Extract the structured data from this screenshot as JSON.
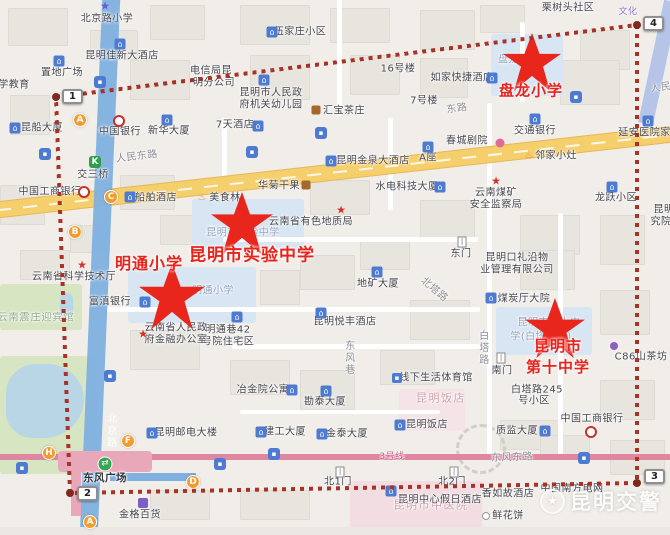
{
  "watermark": {
    "text": "昆明交警"
  },
  "colors": {
    "boundary_dash": "#a93226",
    "school_red": "#e8231c",
    "road_yellow": "#f6cf6d",
    "metro_blue": "#7fb0e0",
    "line3_pink": "#df87a0",
    "station_orange": "#f39c2d"
  },
  "boundary": {
    "corners": [
      [
        56,
        97
      ],
      [
        637,
        25
      ],
      [
        637,
        483
      ],
      [
        70,
        493
      ]
    ],
    "markers": [
      {
        "n": "1",
        "x": 62,
        "y": 89
      },
      {
        "n": "2",
        "x": 77,
        "y": 486
      },
      {
        "n": "3",
        "x": 644,
        "y": 469
      },
      {
        "n": "4",
        "x": 643,
        "y": 16
      }
    ]
  },
  "schools": [
    {
      "name": "盘龙小学",
      "star": {
        "x": 532,
        "y": 62,
        "s": 58
      },
      "label": {
        "lines": [
          "盘龙小学"
        ],
        "x": 531,
        "y": 90,
        "fs": 15
      }
    },
    {
      "name": "明通小学",
      "star": {
        "x": 172,
        "y": 296,
        "s": 66
      },
      "label": {
        "lines": [
          "明通小学"
        ],
        "x": 149,
        "y": 262,
        "fs": 16
      }
    },
    {
      "name": "昆明市实验中学",
      "star": {
        "x": 242,
        "y": 223,
        "s": 62
      },
      "label": {
        "lines": [
          "昆明市实验中学"
        ],
        "x": 252,
        "y": 253,
        "fs": 17
      }
    },
    {
      "name": "昆明市第十中学",
      "star": {
        "x": 555,
        "y": 328,
        "s": 60
      },
      "label": {
        "lines": [
          "昆明市",
          "第十中学"
        ],
        "x": 558,
        "y": 356,
        "fs": 15
      }
    }
  ],
  "stations": [
    {
      "l": "A",
      "x": 80,
      "y": 120
    },
    {
      "l": "C",
      "x": 111,
      "y": 197
    },
    {
      "l": "B",
      "x": 75,
      "y": 232
    },
    {
      "l": "H",
      "x": 49,
      "y": 453
    },
    {
      "l": "F",
      "x": 128,
      "y": 441
    },
    {
      "l": "D",
      "x": 193,
      "y": 482
    },
    {
      "l": "A",
      "x": 90,
      "y": 522
    }
  ],
  "buses": [
    {
      "x": 45,
      "y": 154
    },
    {
      "x": 100,
      "y": 82
    },
    {
      "x": 252,
      "y": 152
    },
    {
      "x": 321,
      "y": 133
    },
    {
      "x": 576,
      "y": 97
    },
    {
      "x": 584,
      "y": 458
    },
    {
      "x": 22,
      "y": 468
    },
    {
      "x": 220,
      "y": 464
    },
    {
      "x": 274,
      "y": 454
    },
    {
      "x": 110,
      "y": 376
    }
  ],
  "icons": [
    {
      "k": "school",
      "x": 105,
      "y": 6
    },
    {
      "k": "building",
      "x": 272,
      "y": 32
    },
    {
      "k": "hotel",
      "x": 120,
      "y": 44
    },
    {
      "k": "building",
      "x": 59,
      "y": 61
    },
    {
      "k": "hotel",
      "x": 492,
      "y": 78
    },
    {
      "k": "building",
      "x": 264,
      "y": 80
    },
    {
      "k": "tea",
      "x": 316,
      "y": 110
    },
    {
      "k": "hotel",
      "x": 258,
      "y": 126
    },
    {
      "k": "hotel",
      "x": 331,
      "y": 161
    },
    {
      "k": "building",
      "x": 428,
      "y": 147
    },
    {
      "k": "flower",
      "x": 500,
      "y": 143
    },
    {
      "k": "building",
      "x": 535,
      "y": 119
    },
    {
      "k": "restaurant",
      "x": 529,
      "y": 156
    },
    {
      "k": "building",
      "x": 648,
      "y": 121
    },
    {
      "k": "building",
      "x": 612,
      "y": 187
    },
    {
      "k": "bank",
      "x": 119,
      "y": 121
    },
    {
      "k": "building",
      "x": 167,
      "y": 120
    },
    {
      "k": "building",
      "x": 15,
      "y": 128
    },
    {
      "k": "rail",
      "x": 95,
      "y": 162
    },
    {
      "k": "metro",
      "x": 84,
      "y": 192
    },
    {
      "k": "hotel",
      "x": 130,
      "y": 197
    },
    {
      "k": "restaurant",
      "x": 202,
      "y": 198
    },
    {
      "k": "basket",
      "x": 306,
      "y": 185
    },
    {
      "k": "building",
      "x": 440,
      "y": 187
    },
    {
      "k": "star",
      "x": 341,
      "y": 210
    },
    {
      "k": "building",
      "x": 377,
      "y": 272
    },
    {
      "k": "hotel",
      "x": 321,
      "y": 313
    },
    {
      "k": "building",
      "x": 237,
      "y": 317
    },
    {
      "k": "building",
      "x": 145,
      "y": 302
    },
    {
      "k": "star",
      "x": 82,
      "y": 265
    },
    {
      "k": "star",
      "x": 143,
      "y": 334
    },
    {
      "k": "gate",
      "x": 462,
      "y": 242
    },
    {
      "k": "building",
      "x": 491,
      "y": 298
    },
    {
      "k": "star",
      "x": 496,
      "y": 181
    },
    {
      "k": "metro",
      "x": 591,
      "y": 432
    },
    {
      "k": "building",
      "x": 545,
      "y": 431
    },
    {
      "k": "dotp",
      "x": 614,
      "y": 346
    },
    {
      "k": "sport",
      "x": 397,
      "y": 378
    },
    {
      "k": "hotel",
      "x": 400,
      "y": 425
    },
    {
      "k": "building",
      "x": 326,
      "y": 391
    },
    {
      "k": "building",
      "x": 292,
      "y": 390
    },
    {
      "k": "building",
      "x": 261,
      "y": 432
    },
    {
      "k": "building",
      "x": 322,
      "y": 434
    },
    {
      "k": "building",
      "x": 152,
      "y": 433
    },
    {
      "k": "transfer",
      "x": 105,
      "y": 464
    },
    {
      "k": "bag",
      "x": 143,
      "y": 503
    },
    {
      "k": "gate",
      "x": 340,
      "y": 472
    },
    {
      "k": "gate",
      "x": 454,
      "y": 472
    },
    {
      "k": "hotel",
      "x": 391,
      "y": 491
    },
    {
      "k": "gate",
      "x": 501,
      "y": 358
    },
    {
      "k": "ring",
      "x": 486,
      "y": 516
    }
  ],
  "pois": [
    {
      "t": "北京路小学",
      "x": 107,
      "y": 19
    },
    {
      "t": "栗树头社区",
      "x": 568,
      "y": 8
    },
    {
      "t": "伍家庄小区",
      "x": 300,
      "y": 32
    },
    {
      "t": "昆明佳新大酒店",
      "x": 122,
      "y": 56
    },
    {
      "t": "置地广场",
      "x": 62,
      "y": 73
    },
    {
      "t": "电信局昆",
      "x": 211,
      "y": 71
    },
    {
      "t": "明分公司",
      "x": 214,
      "y": 83
    },
    {
      "t": "如家快捷酒店",
      "x": 462,
      "y": 78
    },
    {
      "t": "昆明市人民政",
      "x": 271,
      "y": 93
    },
    {
      "t": "府机关幼儿园",
      "x": 271,
      "y": 105
    },
    {
      "t": "16号楼",
      "x": 398,
      "y": 69
    },
    {
      "t": "7号楼",
      "x": 424,
      "y": 101
    },
    {
      "t": "汇宝茶庄",
      "x": 344,
      "y": 111
    },
    {
      "t": "7天酒店",
      "x": 235,
      "y": 125
    },
    {
      "t": "昆明金泉大酒店",
      "x": 373,
      "y": 161
    },
    {
      "t": "A座",
      "x": 428,
      "y": 158
    },
    {
      "t": "春城剧院",
      "x": 467,
      "y": 141
    },
    {
      "t": "交通银行",
      "x": 535,
      "y": 131
    },
    {
      "t": "邻家小灶",
      "x": 556,
      "y": 156
    },
    {
      "t": "延安医院家属区",
      "x": 655,
      "y": 133
    },
    {
      "t": "龙跃小区",
      "x": 616,
      "y": 198
    },
    {
      "t": "昆明",
      "x": 664,
      "y": 210
    },
    {
      "t": "究院",
      "x": 661,
      "y": 222
    },
    {
      "t": "中国银行",
      "x": 120,
      "y": 132
    },
    {
      "t": "新华大厦",
      "x": 169,
      "y": 131
    },
    {
      "t": "昆船大厦",
      "x": 42,
      "y": 128
    },
    {
      "t": "学教育",
      "x": 14,
      "y": 85
    },
    {
      "t": "交三桥",
      "x": 93,
      "y": 175
    },
    {
      "t": "中国工商银行",
      "x": 50,
      "y": 192
    },
    {
      "t": "船舶酒店",
      "x": 156,
      "y": 198
    },
    {
      "t": "美食林",
      "x": 225,
      "y": 198
    },
    {
      "t": "华菊干果",
      "x": 279,
      "y": 186
    },
    {
      "t": "水电科技大厦",
      "x": 407,
      "y": 187
    },
    {
      "t": "云南省有色地质局",
      "x": 311,
      "y": 222
    },
    {
      "t": "地矿大厦",
      "x": 378,
      "y": 284
    },
    {
      "t": "北塔路",
      "x": 434,
      "y": 290,
      "cls": "roadlbl",
      "rot": 40
    },
    {
      "t": "昆明悦丰酒店",
      "x": 345,
      "y": 322
    },
    {
      "t": "明通巷42",
      "x": 228,
      "y": 330
    },
    {
      "t": "号院住宅区",
      "x": 228,
      "y": 342
    },
    {
      "t": "云南省人民政",
      "x": 176,
      "y": 328
    },
    {
      "t": "府金融办公室",
      "x": 176,
      "y": 340
    },
    {
      "t": "富滇银行",
      "x": 110,
      "y": 302
    },
    {
      "t": "云南省科学技术厅",
      "x": 74,
      "y": 277
    },
    {
      "t": "云南震庄迎宾馆",
      "x": 36,
      "y": 318,
      "cls": "areaGreen"
    },
    {
      "t": "东门",
      "x": 461,
      "y": 254
    },
    {
      "t": "昆明口礼沿物",
      "x": 517,
      "y": 258
    },
    {
      "t": "业管理有限公司",
      "x": 517,
      "y": 270
    },
    {
      "t": "煤炭厅大院",
      "x": 524,
      "y": 299
    },
    {
      "t": "云南煤矿",
      "x": 496,
      "y": 193
    },
    {
      "t": "安全监察局",
      "x": 496,
      "y": 205
    },
    {
      "t": "昆明市第十中",
      "x": 549,
      "y": 323,
      "cls": "g"
    },
    {
      "t": "学(白塔校区)",
      "x": 541,
      "y": 337,
      "cls": "g"
    },
    {
      "t": "中国工商银行",
      "x": 592,
      "y": 419
    },
    {
      "t": "质监大厦",
      "x": 517,
      "y": 431
    },
    {
      "t": "C86山茶坊",
      "x": 641,
      "y": 357
    },
    {
      "t": "线下生活体育馆",
      "x": 436,
      "y": 378
    },
    {
      "t": "昆明饭店",
      "x": 441,
      "y": 399,
      "cls": "areaPink"
    },
    {
      "t": "昆明饭店",
      "x": 427,
      "y": 425
    },
    {
      "t": "勘泰大厦",
      "x": 325,
      "y": 402
    },
    {
      "t": "冶金院公寓",
      "x": 263,
      "y": 390
    },
    {
      "t": "建工大厦",
      "x": 285,
      "y": 432
    },
    {
      "t": "金泰大厦",
      "x": 347,
      "y": 434
    },
    {
      "t": "昆明邮电大楼",
      "x": 186,
      "y": 433
    },
    {
      "t": "东风广场",
      "x": 105,
      "y": 478,
      "cls": "dark"
    },
    {
      "t": "金格百货",
      "x": 140,
      "y": 515
    },
    {
      "t": "北1门",
      "x": 338,
      "y": 482
    },
    {
      "t": "北2门",
      "x": 452,
      "y": 482
    },
    {
      "t": "昆明市中医院",
      "x": 431,
      "y": 506,
      "cls": "areaPink"
    },
    {
      "t": "昆明中心假日酒店",
      "x": 440,
      "y": 500
    },
    {
      "t": "南门",
      "x": 502,
      "y": 371
    },
    {
      "t": "白塔路245",
      "x": 537,
      "y": 390
    },
    {
      "t": "号小区",
      "x": 534,
      "y": 401
    },
    {
      "t": "香如故酒店",
      "x": 508,
      "y": 494
    },
    {
      "t": "中国南方电网",
      "x": 572,
      "y": 489
    },
    {
      "t": "鲜花饼",
      "x": 508,
      "y": 516
    },
    {
      "t": "盘龙小学",
      "x": 519,
      "y": 60,
      "cls": "g"
    },
    {
      "t": "明通小学",
      "x": 213,
      "y": 291,
      "cls": "g"
    },
    {
      "t": "昆明市实验中学",
      "x": 243,
      "y": 233,
      "cls": "g"
    },
    {
      "t": "东风巷",
      "x": 348,
      "y": 358,
      "cls": "roadlbl vert"
    },
    {
      "t": "北京路",
      "x": 110,
      "y": 431,
      "cls": "whitelbl vert"
    },
    {
      "t": "白塔路",
      "x": 482,
      "y": 348,
      "cls": "roadlbl vert"
    },
    {
      "t": "3号线",
      "x": 392,
      "y": 457,
      "cls": "pink3"
    },
    {
      "t": "人民东路",
      "x": 137,
      "y": 157,
      "cls": "roadlbl",
      "rot": -7
    },
    {
      "t": "东路",
      "x": 457,
      "y": 109,
      "cls": "roadlbl",
      "rot": -8
    },
    {
      "t": "人民",
      "x": 661,
      "y": 88,
      "cls": "roadlbl",
      "rot": -8
    },
    {
      "t": "东风东路",
      "x": 512,
      "y": 458,
      "cls": "roadlbl",
      "rot": -2
    },
    {
      "t": "文化",
      "x": 628,
      "y": 12,
      "cls": "purple"
    }
  ]
}
